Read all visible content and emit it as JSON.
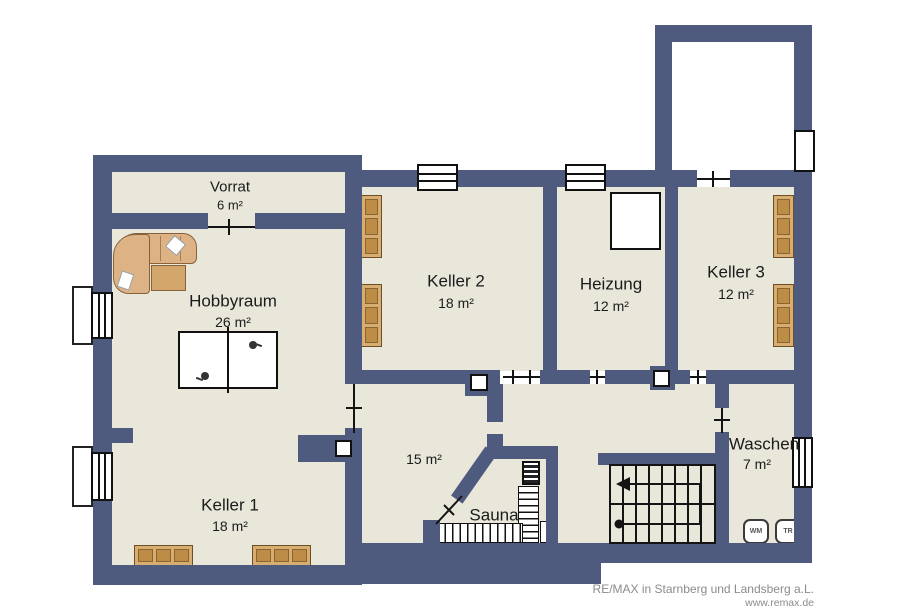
{
  "colors": {
    "wall": "#4e5b7e",
    "floor": "#e9e6da",
    "line": "#141414",
    "furniture": "#d8ad72",
    "furniture_dark": "#bd8d47",
    "text": "#1b1b1b",
    "footer_text": "#8b8b8b"
  },
  "rooms": {
    "vorrat": {
      "name": "Vorrat",
      "area": "6 m²"
    },
    "hobbyraum": {
      "name": "Hobbyraum",
      "area": "26 m²"
    },
    "keller1": {
      "name": "Keller 1",
      "area": "18 m²"
    },
    "keller2": {
      "name": "Keller 2",
      "area": "18 m²"
    },
    "heizung": {
      "name": "Heizung",
      "area": "12 m²"
    },
    "keller3": {
      "name": "Keller 3",
      "area": "12 m²"
    },
    "flur": {
      "name": "",
      "area": "15 m²"
    },
    "sauna": {
      "name": "Sauna",
      "area": ""
    },
    "waschen": {
      "name": "Waschen",
      "area": "7 m²"
    }
  },
  "appliances": {
    "washer": "WM",
    "dryer": "TR"
  },
  "footer": {
    "line1": "RE/MAX in Starnberg und Landsberg a.L.",
    "line2": "www.remax.de"
  }
}
